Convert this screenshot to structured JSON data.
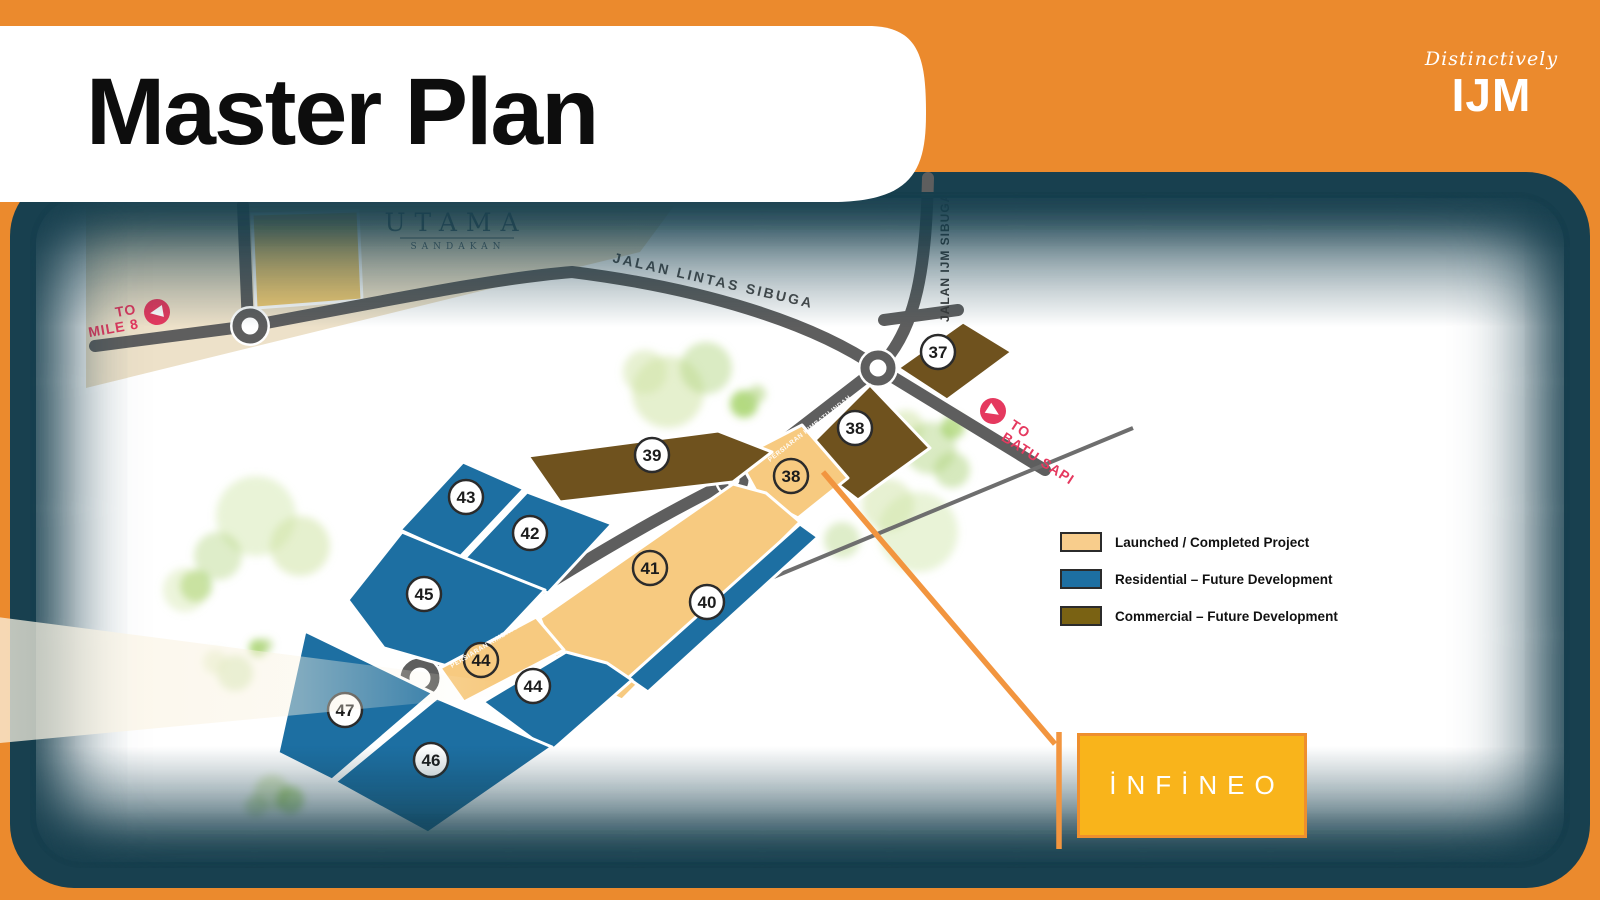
{
  "header": {
    "title": "Master Plan"
  },
  "brand": {
    "tagline": "Distinctively",
    "name": "IJM",
    "bg": "#1F83C3"
  },
  "colors": {
    "slide_bg": "#EB8A2D",
    "frame": "#18404F",
    "launched": "#F7CA80",
    "residential": "#1D6FA2",
    "commercial": "#6F521E",
    "road": "#5E5E5E",
    "callout_orange": "#F2953F",
    "direction_pink": "#E5395F"
  },
  "map": {
    "estate_logo": {
      "title": "UTAMA",
      "subtitle": "SANDAKAN"
    },
    "road_names": {
      "lintas": "JALAN LINTAS SIBUGA",
      "ijm": "JALAN IJM SIBUGA",
      "persiaran": "PERSIARAN KIMBATU INDAH"
    },
    "directions": [
      {
        "lines": [
          "TO",
          "MILE 8"
        ]
      },
      {
        "lines": [
          "TO",
          "BATU SAPI"
        ]
      }
    ],
    "lots": [
      {
        "number": "37",
        "type": "commercial"
      },
      {
        "number": "38",
        "type": "commercial"
      },
      {
        "number": "38",
        "type": "launched"
      },
      {
        "number": "39",
        "type": "commercial"
      },
      {
        "number": "43",
        "type": "residential"
      },
      {
        "number": "42",
        "type": "residential"
      },
      {
        "number": "45",
        "type": "residential"
      },
      {
        "number": "41",
        "type": "launched"
      },
      {
        "number": "40",
        "type": "residential"
      },
      {
        "number": "44",
        "type": "launched"
      },
      {
        "number": "44",
        "type": "residential"
      },
      {
        "number": "47",
        "type": "residential"
      },
      {
        "number": "46",
        "type": "residential"
      }
    ]
  },
  "legend": {
    "items": [
      {
        "label": "Launched / Completed Project",
        "color": "#F8CD8C"
      },
      {
        "label": "Residential – Future Development",
        "color": "#1D6FA2"
      },
      {
        "label": "Commercial – Future Development",
        "color": "#7A6213"
      }
    ]
  },
  "infineo": {
    "logo_text": "İNFİNEO"
  }
}
